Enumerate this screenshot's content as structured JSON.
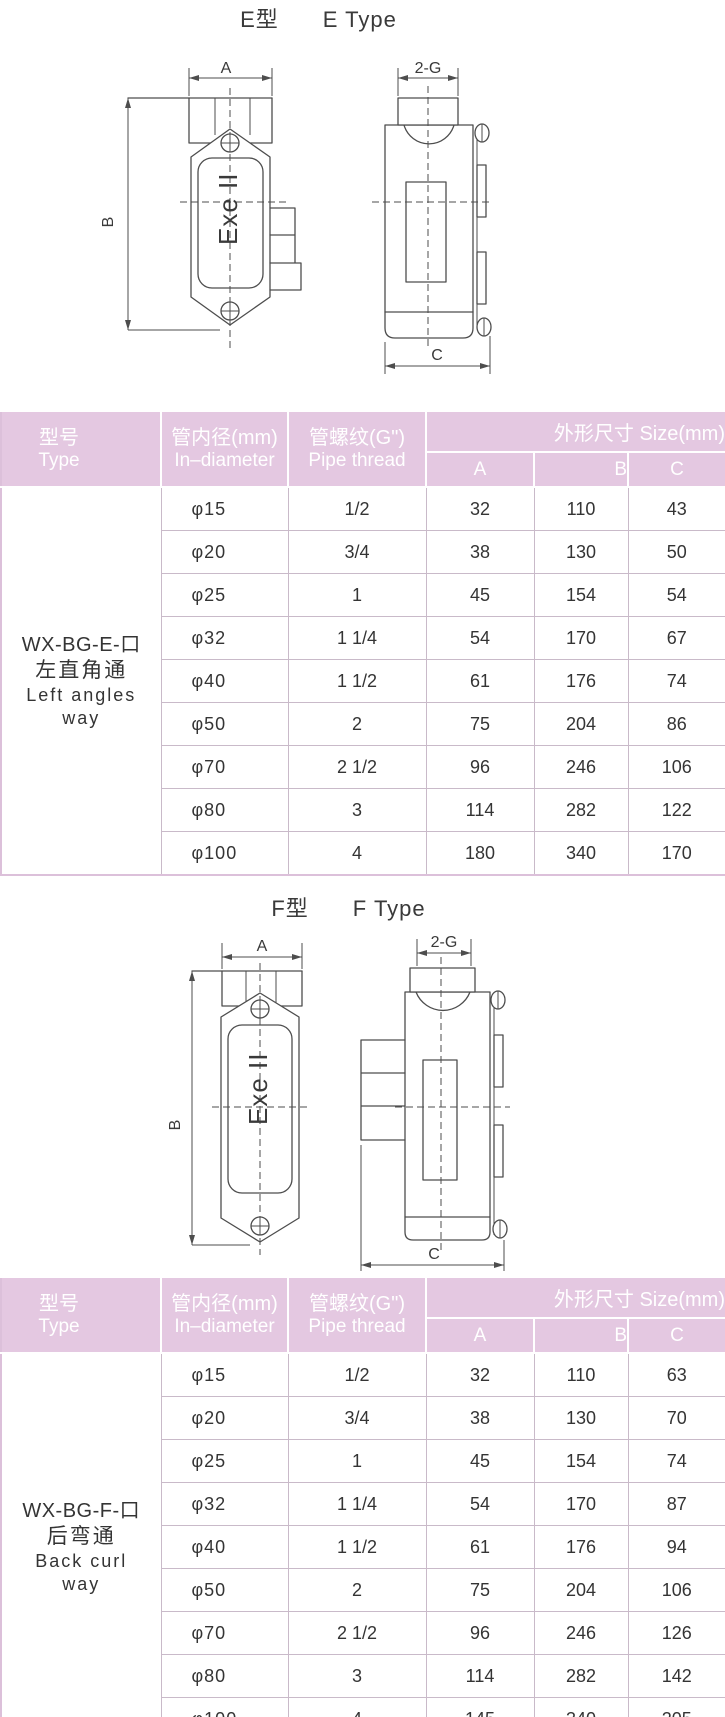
{
  "colors": {
    "header_bg": "#e4c8e1",
    "header_text": "#ffffff",
    "grid_line": "#c9bac9",
    "outer_border": "#dcc0da",
    "drawing_line": "#4d4d4d",
    "text": "#343434"
  },
  "sections": [
    {
      "title_zh": "E型",
      "title_en": "E Type",
      "drawing": {
        "dim_a": "A",
        "dim_b": "B",
        "dim_c": "C",
        "dim_g": "2-G",
        "plate_label": "Exe II"
      },
      "table": {
        "headers": {
          "col_type_zh": "型号",
          "col_type_en": "Type",
          "col_diameter_zh": "管内径(mm)",
          "col_diameter_en": "In–diameter",
          "col_thread_zh": "管螺纹(G\")",
          "col_thread_en": "Pipe thread",
          "col_size": "外形尺寸 Size(mm)",
          "sub_a": "A",
          "sub_b": "B",
          "sub_c": "C"
        },
        "model": {
          "code": "WX-BG-E-口",
          "name_zh": "左直角通",
          "name_en_1": "Left angles",
          "name_en_2": "way"
        },
        "rows": [
          {
            "d": "φ15",
            "t": "1/2",
            "a": "32",
            "b": "110",
            "c": "43"
          },
          {
            "d": "φ20",
            "t": "3/4",
            "a": "38",
            "b": "130",
            "c": "50"
          },
          {
            "d": "φ25",
            "t": "1",
            "a": "45",
            "b": "154",
            "c": "54"
          },
          {
            "d": "φ32",
            "t": "1 1/4",
            "a": "54",
            "b": "170",
            "c": "67"
          },
          {
            "d": "φ40",
            "t": "1 1/2",
            "a": "61",
            "b": "176",
            "c": "74"
          },
          {
            "d": "φ50",
            "t": "2",
            "a": "75",
            "b": "204",
            "c": "86"
          },
          {
            "d": "φ70",
            "t": "2 1/2",
            "a": "96",
            "b": "246",
            "c": "106"
          },
          {
            "d": "φ80",
            "t": "3",
            "a": "114",
            "b": "282",
            "c": "122"
          },
          {
            "d": "φ100",
            "t": "4",
            "a": "180",
            "b": "340",
            "c": "170"
          }
        ]
      }
    },
    {
      "title_zh": "F型",
      "title_en": "F Type",
      "drawing": {
        "dim_a": "A",
        "dim_b": "B",
        "dim_c": "C",
        "dim_g": "2-G",
        "plate_label": "Exe II"
      },
      "table": {
        "headers": {
          "col_type_zh": "型号",
          "col_type_en": "Type",
          "col_diameter_zh": "管内径(mm)",
          "col_diameter_en": "In–diameter",
          "col_thread_zh": "管螺纹(G\")",
          "col_thread_en": "Pipe thread",
          "col_size": "外形尺寸 Size(mm)",
          "sub_a": "A",
          "sub_b": "B",
          "sub_c": "C"
        },
        "model": {
          "code": "WX-BG-F-口",
          "name_zh": "后弯通",
          "name_en_1": "Back curl",
          "name_en_2": "way"
        },
        "rows": [
          {
            "d": "φ15",
            "t": "1/2",
            "a": "32",
            "b": "110",
            "c": "63"
          },
          {
            "d": "φ20",
            "t": "3/4",
            "a": "38",
            "b": "130",
            "c": "70"
          },
          {
            "d": "φ25",
            "t": "1",
            "a": "45",
            "b": "154",
            "c": "74"
          },
          {
            "d": "φ32",
            "t": "1 1/4",
            "a": "54",
            "b": "170",
            "c": "87"
          },
          {
            "d": "φ40",
            "t": "1 1/2",
            "a": "61",
            "b": "176",
            "c": "94"
          },
          {
            "d": "φ50",
            "t": "2",
            "a": "75",
            "b": "204",
            "c": "106"
          },
          {
            "d": "φ70",
            "t": "2 1/2",
            "a": "96",
            "b": "246",
            "c": "126"
          },
          {
            "d": "φ80",
            "t": "3",
            "a": "114",
            "b": "282",
            "c": "142"
          },
          {
            "d": "φ100",
            "t": "4",
            "a": "145",
            "b": "340",
            "c": "205"
          }
        ]
      }
    }
  ]
}
